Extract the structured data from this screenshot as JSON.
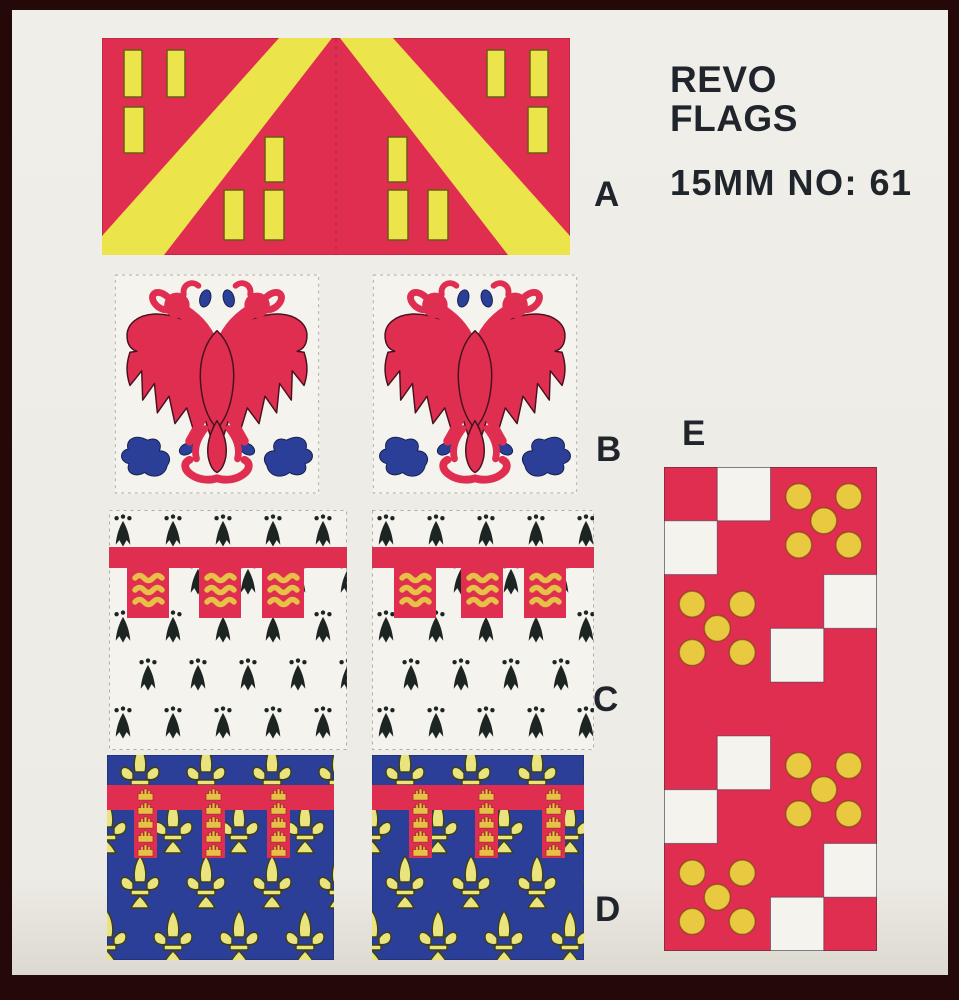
{
  "product": {
    "brand_line1": "REVO",
    "brand_line2": "FLAGS",
    "size_line": "15MM NO: 61"
  },
  "labels": {
    "flag_a": "A",
    "flag_b": "B",
    "flag_c": "C",
    "flag_d": "D",
    "flag_e": "E"
  },
  "flags": {
    "a": {
      "desc": "red flag, two mirrored faces, yellow bend and yellow billets"
    },
    "b": {
      "desc": "white flag with red double-headed eagle, blue claws and base foliage"
    },
    "c": {
      "desc": "white ermine flag with red label, pendants charged with gold lions"
    },
    "d": {
      "desc": "blue flag semy of gold fleurs-de-lis, red label charged with gold castles"
    },
    "e": {
      "desc": "red and white checky flag, red squares charged with five gold bezants"
    }
  },
  "colors": {
    "frame": "#240908",
    "paper": "#edebe5",
    "white": "#f4f3ee",
    "red": "#df2e4f",
    "yellow": "#ebe44a",
    "paleyellow": "#eae47e",
    "gold": "#e6c047",
    "bezant": "#e9c93f",
    "blue": "#2c3f98",
    "ink": "#20242b",
    "black": "#1c2522"
  },
  "flag_e": {
    "cols": 4,
    "pattern_rows": [
      "RWBB",
      "WRBB",
      "BBRW",
      "BBWR",
      "RRRR",
      "RWBB",
      "WRBB",
      "BBRW",
      "BBWR"
    ],
    "bezant_groups": [
      {
        "col": 2,
        "row": 0
      },
      {
        "col": 0,
        "row": 2
      },
      {
        "col": 2,
        "row": 5
      },
      {
        "col": 0,
        "row": 7
      }
    ],
    "bezant_offsets": [
      [
        -0.47,
        -0.45
      ],
      [
        0.47,
        -0.45
      ],
      [
        0,
        0
      ],
      [
        -0.47,
        0.45
      ],
      [
        0.47,
        0.45
      ]
    ],
    "bezant_radius": 13
  }
}
